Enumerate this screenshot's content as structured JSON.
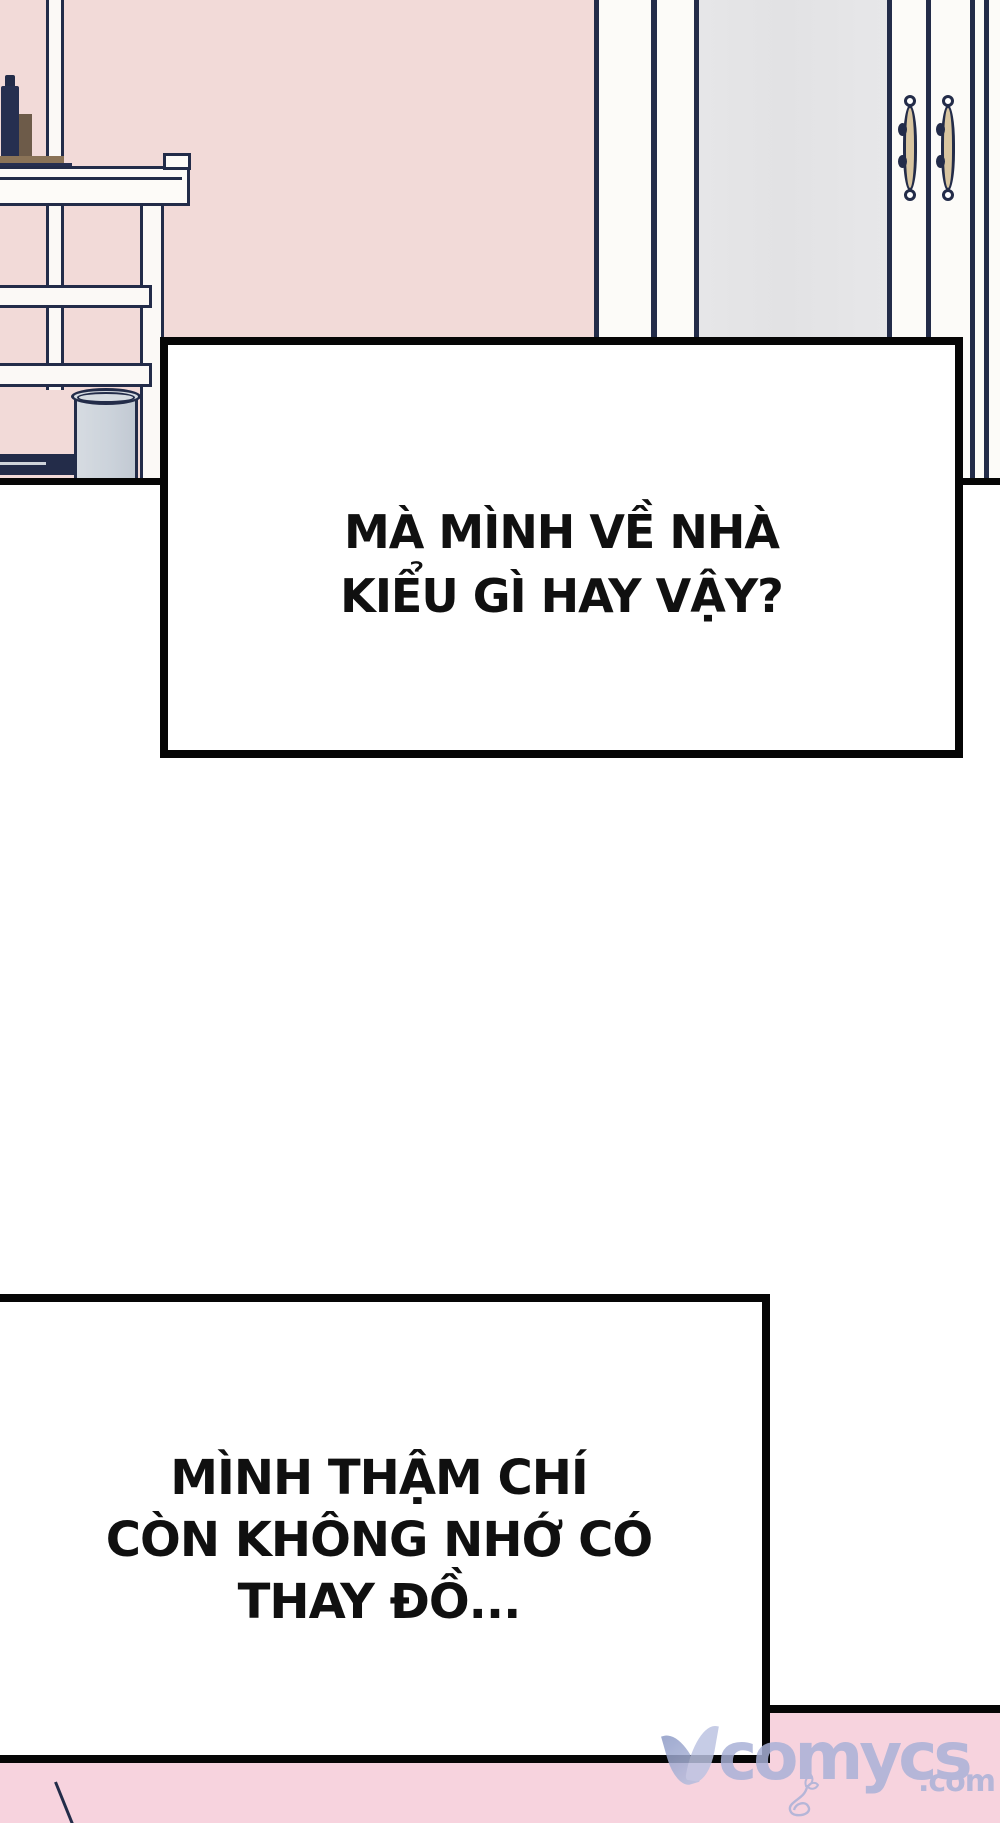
{
  "panels": {
    "box1": {
      "lines": [
        "MÀ MÌNH VỀ NHÀ",
        "KIỂU GÌ HAY VẬY?"
      ]
    },
    "box2": {
      "lines": [
        "MÌNH THẬM CHÍ",
        "CÒN KHÔNG NHỚ CÓ",
        "THAY ĐỒ..."
      ]
    }
  },
  "watermark": {
    "brand": "comycs",
    "tld": ".com"
  },
  "colors": {
    "wall_pink": "#f2dad8",
    "floor_pink": "#f7d3de",
    "outline_navy": "#232c49",
    "panel_border_black": "#060606",
    "wardrobe_gray": "#e3e3e5",
    "handle_tan": "#d8c5a0",
    "trash_gray": "#ccd3db",
    "watermark_periwinkle": "#a9b1d7"
  }
}
